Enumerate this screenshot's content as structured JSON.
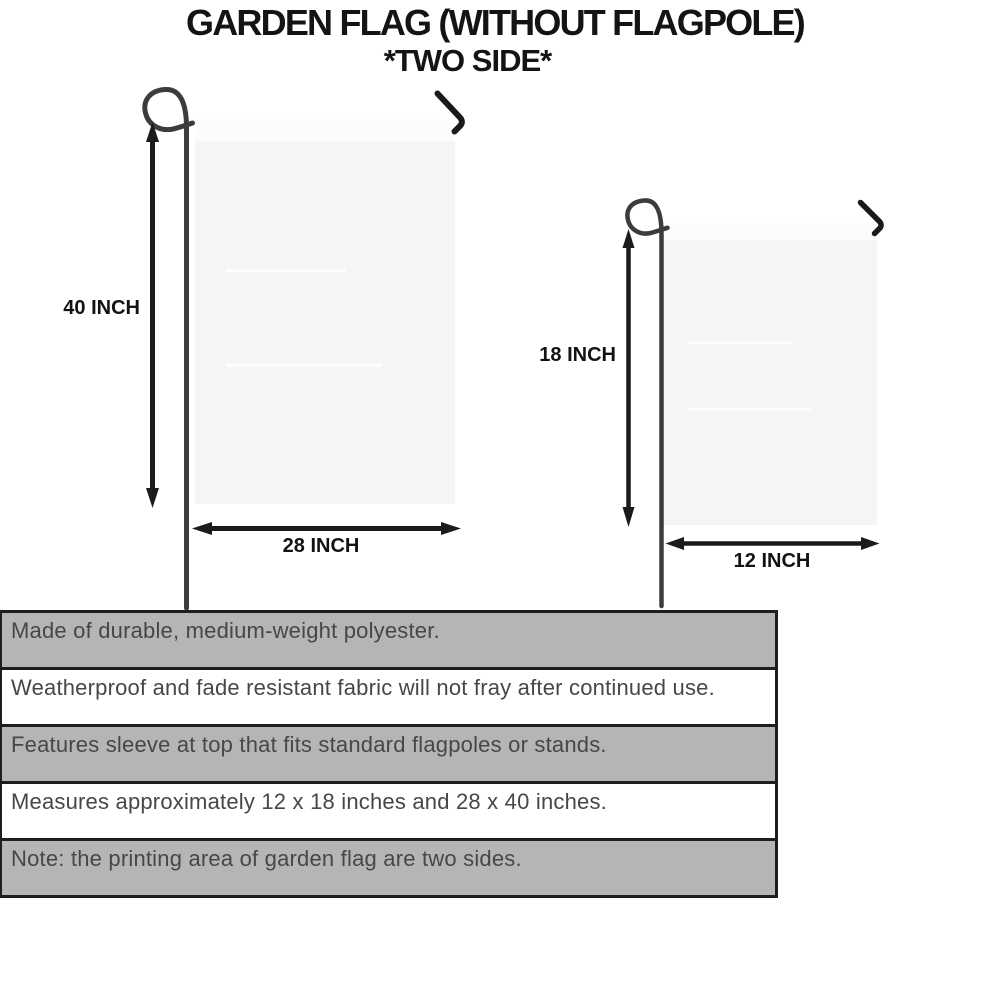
{
  "title": {
    "line1": "GARDEN FLAG (WITHOUT FLAGPOLE)",
    "line2": "*TWO SIDE*"
  },
  "flags": {
    "large": {
      "height_label": "40 INCH",
      "width_label": "28 INCH"
    },
    "small": {
      "height_label": "18 INCH",
      "width_label": "12 INCH"
    }
  },
  "features": [
    {
      "text": "Made of durable, medium-weight polyester."
    },
    {
      "text": "Weatherproof and fade resistant fabric will not fray after continued use."
    },
    {
      "text": "Features sleeve at top that fits standard flagpoles or stands."
    },
    {
      "text": "Measures approximately 12 x 18 inches and 28 x 40 inches."
    },
    {
      "text": "Note: the printing area of garden flag are two sides."
    }
  ],
  "colors": {
    "row_shaded": "#b5b5b5",
    "row_plain": "#ffffff",
    "table_border": "#1e1e1e",
    "flag_fill": "#f5f5f6",
    "pole": "#3c3c3c",
    "hook": "#1a1a1a",
    "arrow": "#1b1b1b",
    "feature_text": "#474747",
    "title_text": "#141414"
  }
}
